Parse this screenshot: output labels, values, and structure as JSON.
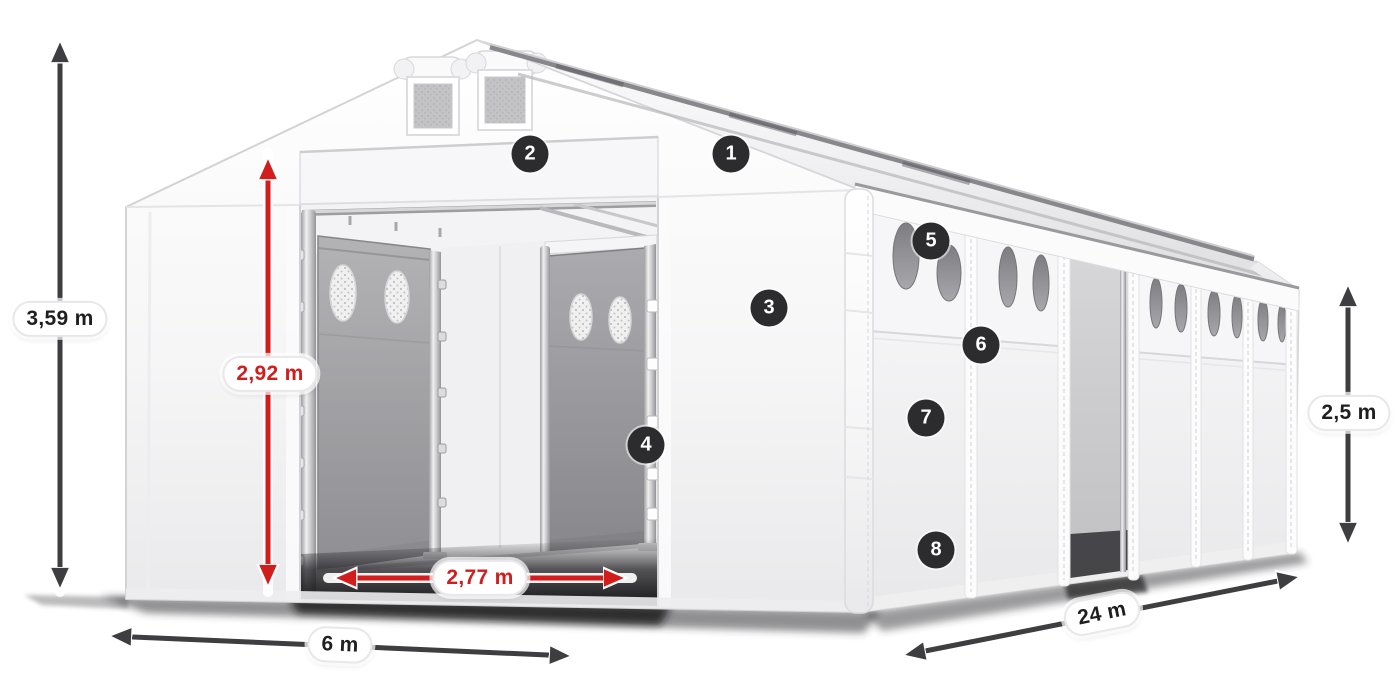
{
  "diagram": {
    "background_color": "#ffffff",
    "colors": {
      "dimension_arrow_dark": "#3e3e40",
      "dimension_arrow_red": "#d21d1d",
      "dimension_text_dark": "#1f1f21",
      "dimension_text_red": "#d21d1d",
      "callout_background": "#2c2c2e",
      "callout_text": "#ffffff",
      "tent_fabric": "#ffffff",
      "door_panel_gray": "#a6a6aa",
      "side_window_gray": "#8a8a8e"
    },
    "dimension_labels": {
      "total_height": "3,59 m",
      "entrance_height": "2,92 m",
      "entrance_width": "2,77 m",
      "front_width": "6 m",
      "side_wall_height": "2,5 m",
      "length": "24 m"
    },
    "callout_numbers": [
      "1",
      "2",
      "3",
      "4",
      "5",
      "6",
      "7",
      "8"
    ]
  }
}
